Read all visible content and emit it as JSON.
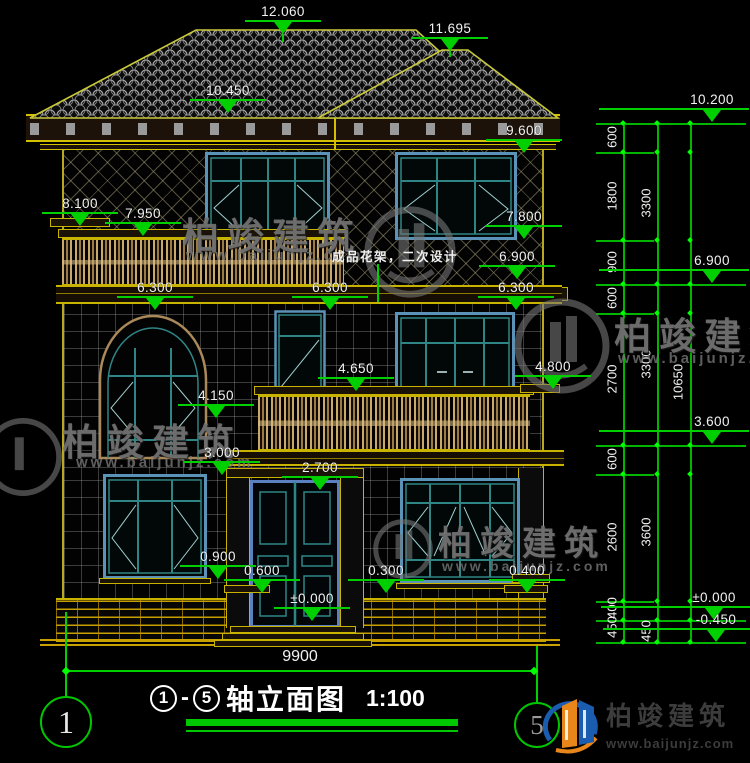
{
  "drawing": {
    "note": "成品花架，二次设计",
    "overall_width_dim": "9900",
    "title": {
      "axis_start": "1",
      "separator": "-",
      "axis_end": "5",
      "name": "轴立面图",
      "scale": "1:100"
    },
    "axis_bubbles": {
      "left": "1",
      "right": "5"
    }
  },
  "brand": {
    "name": "柏竣建筑",
    "site": "www.baijunjz.com"
  },
  "colors": {
    "background": "#000000",
    "dimension_line_green": "#00cf00",
    "dimension_text_white": "#f2f2f2",
    "outline_yellow": "#c8b400",
    "window_teal": "#2f8585",
    "window_blue": "#5b93b8",
    "baluster_tan": "#c9a96a",
    "watermark_gray": "#7a7a7a",
    "brand_blue": "#1a5cb0",
    "brand_orange": "#e8861a"
  },
  "elevation_markers": [
    {
      "label": "12.060",
      "x": 283,
      "y": 4,
      "stem": 8
    },
    {
      "label": "11.695",
      "x": 450,
      "y": 21,
      "stem": 6
    },
    {
      "label": "10.450",
      "x": 228,
      "y": 83
    },
    {
      "label": "9.600",
      "x": 524,
      "y": 123
    },
    {
      "label": "7.800",
      "x": 524,
      "y": 209
    },
    {
      "label": "6.900",
      "x": 517,
      "y": 249
    },
    {
      "label": "8.100",
      "x": 80,
      "y": 196
    },
    {
      "label": "7.950",
      "x": 143,
      "y": 206
    },
    {
      "label": "6.300",
      "x": 155,
      "y": 280
    },
    {
      "label": "6.300",
      "x": 330,
      "y": 280
    },
    {
      "label": "6.300",
      "x": 516,
      "y": 280
    },
    {
      "label": "4.650",
      "x": 356,
      "y": 361
    },
    {
      "label": "4.800",
      "x": 553,
      "y": 359
    },
    {
      "label": "4.150",
      "x": 216,
      "y": 388
    },
    {
      "label": "3.000",
      "x": 222,
      "y": 445
    },
    {
      "label": "2.700",
      "x": 320,
      "y": 460
    },
    {
      "label": "0.900",
      "x": 218,
      "y": 549
    },
    {
      "label": "0.600",
      "x": 262,
      "y": 563
    },
    {
      "label": "0.300",
      "x": 386,
      "y": 563
    },
    {
      "label": "0.400",
      "x": 527,
      "y": 563
    },
    {
      "label": "±0.000",
      "x": 312,
      "y": 591
    },
    {
      "label": "10.200",
      "x": 712,
      "y": 92,
      "side": "right"
    },
    {
      "label": "6.900",
      "x": 712,
      "y": 253,
      "side": "right"
    },
    {
      "label": "3.600",
      "x": 712,
      "y": 414,
      "side": "right"
    },
    {
      "label": "±0.000",
      "x": 714,
      "y": 590,
      "side": "right"
    },
    {
      "label": "-0.450",
      "x": 716,
      "y": 612,
      "side": "right"
    }
  ],
  "right_chain": {
    "x_cols": [
      623,
      657,
      690
    ],
    "top": 123,
    "bottom": 642,
    "ticks": [
      {
        "y": 123,
        "major": true
      },
      {
        "y": 152
      },
      {
        "y": 240
      },
      {
        "y": 284,
        "major": true
      },
      {
        "y": 313
      },
      {
        "y": 445,
        "major": true
      },
      {
        "y": 474
      },
      {
        "y": 601
      },
      {
        "y": 620,
        "major": true
      },
      {
        "y": 642,
        "major": true
      }
    ],
    "labels": [
      {
        "t": "600",
        "x": 612,
        "y": 137
      },
      {
        "t": "1800",
        "x": 612,
        "y": 196
      },
      {
        "t": "900",
        "x": 612,
        "y": 262
      },
      {
        "t": "600",
        "x": 612,
        "y": 298
      },
      {
        "t": "2700",
        "x": 612,
        "y": 379
      },
      {
        "t": "600",
        "x": 612,
        "y": 459
      },
      {
        "t": "2600",
        "x": 612,
        "y": 537
      },
      {
        "t": "400",
        "x": 612,
        "y": 608
      },
      {
        "t": "450",
        "x": 612,
        "y": 627
      },
      {
        "t": "3300",
        "x": 646,
        "y": 203
      },
      {
        "t": "3300",
        "x": 646,
        "y": 364
      },
      {
        "t": "3600",
        "x": 646,
        "y": 532
      },
      {
        "t": "450",
        "x": 646,
        "y": 631
      },
      {
        "t": "10650",
        "x": 678,
        "y": 382
      }
    ]
  }
}
